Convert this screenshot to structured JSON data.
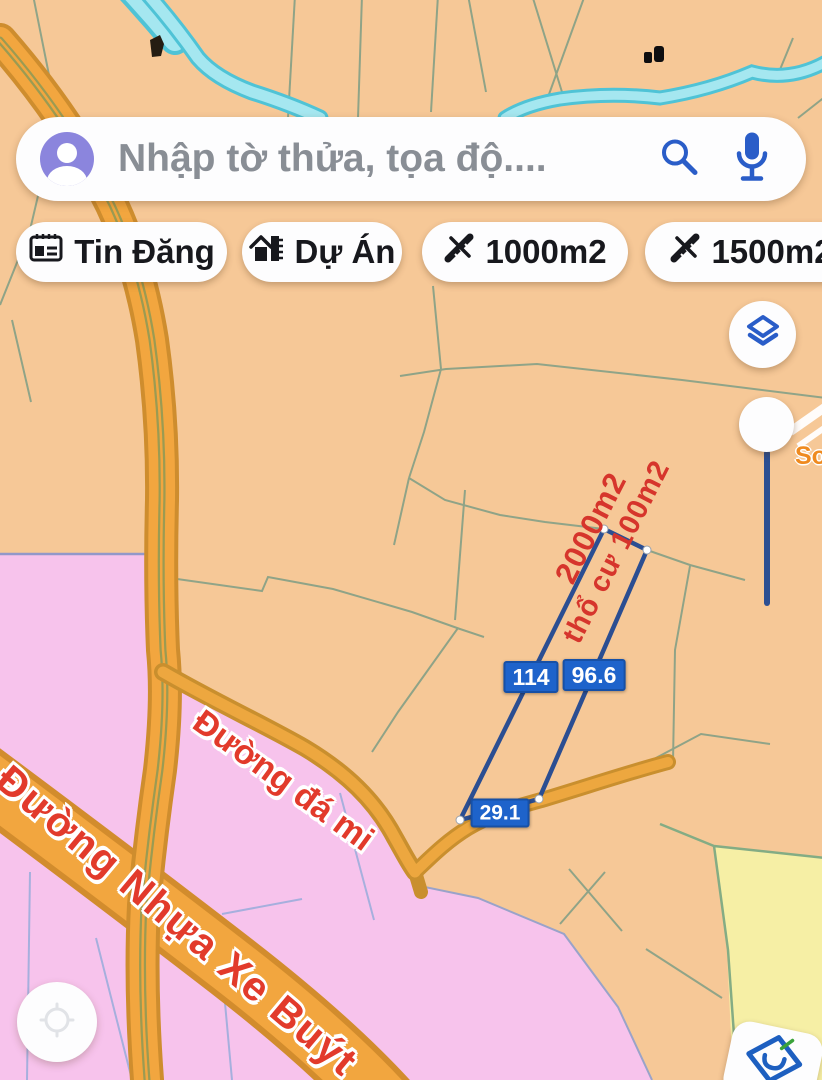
{
  "search": {
    "placeholder": "Nhập tờ thửa, tọa độ....",
    "avatar_icon": "user-avatar-icon",
    "search_icon": "magnifier-icon",
    "mic_icon": "microphone-icon"
  },
  "filter_chips": [
    {
      "label": "Tin Đăng",
      "icon": "listing-grid-icon"
    },
    {
      "label": "Dự Án",
      "icon": "project-house-icon"
    },
    {
      "label": "1000m2",
      "icon": "area-measure-icon"
    },
    {
      "label": "1500m2",
      "icon": "area-measure-icon"
    }
  ],
  "map": {
    "selected_parcel": {
      "area_labels": [
        "2000m2",
        "thổ cư 100m2"
      ],
      "edge_measurements": [
        {
          "edge": "left-side",
          "value": "114"
        },
        {
          "edge": "right-side",
          "value": "96.6"
        },
        {
          "edge": "road-frontage",
          "value": "29.1"
        }
      ],
      "outline_color": "#2b4e92"
    },
    "road_labels": [
      {
        "text": "Đường đá mi"
      },
      {
        "text": "Đường Nhựa Xe Buýt"
      }
    ],
    "zone_colors": {
      "parcel_tan": "#f6c897",
      "planning_pink": "#f7c3ec",
      "planning_yellow": "#f6efa5",
      "water_cyan": "#a5e7f0",
      "road_orange": "#f2a63f"
    },
    "label_red": "#d6352c",
    "measure_badge_blue": "#1e63cb",
    "accent_blue": "#2a5dc8"
  },
  "controls": {
    "layers_button_icon": "layers-icon",
    "zoom_slider_icon": "slider-knob",
    "locate_button_icon": "compass-icon",
    "app_logo_icon": "diamond-logo"
  },
  "watermark": {
    "text": "So"
  }
}
